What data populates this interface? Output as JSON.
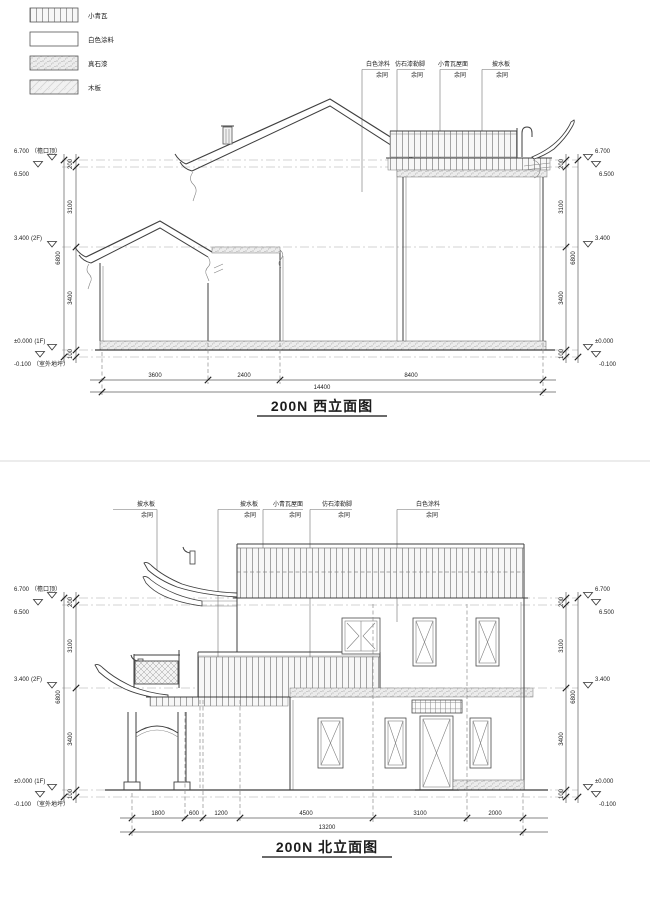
{
  "page": {
    "bg": "#ffffff",
    "divider_color": "#d8d8d8",
    "line_color": "#3f3f3f"
  },
  "legend": {
    "items": [
      {
        "id": "tile",
        "label": "小青瓦"
      },
      {
        "id": "white-paint",
        "label": "白色涂料"
      },
      {
        "id": "stone-paint",
        "label": "真石漆"
      },
      {
        "id": "wood",
        "label": "木板"
      }
    ]
  },
  "west": {
    "title": "200N 西立面图",
    "callouts": [
      {
        "label": "白色涂料",
        "sub": "余同"
      },
      {
        "label": "仿石漆勒脚",
        "sub": "余同"
      },
      {
        "label": "小青瓦屋面",
        "sub": "余同"
      },
      {
        "label": "披水板",
        "sub": "余同"
      }
    ],
    "levels_left": [
      {
        "value": "6.700",
        "note": "（檐口顶）"
      },
      {
        "value": "6.500",
        "note": ""
      },
      {
        "value": "3.400",
        "note": "(2F)"
      },
      {
        "value": "±0.000",
        "note": "(1F)"
      },
      {
        "value": "-0.100",
        "note": "（室外地坪）"
      }
    ],
    "levels_right": [
      "6.700",
      "6.500",
      "3.400",
      "±0.000",
      "-0.100"
    ],
    "vdims": [
      "200",
      "3100",
      "3400",
      "100"
    ],
    "vtotal": "6800",
    "hdims": [
      "3600",
      "2400",
      "8400"
    ],
    "htotal": "14400"
  },
  "north": {
    "title": "200N 北立面图",
    "callouts": [
      {
        "label": "披水板",
        "sub": "余同"
      },
      {
        "label": "披水板",
        "sub": "余同"
      },
      {
        "label": "小青瓦屋面",
        "sub": "余同"
      },
      {
        "label": "仿石漆勒脚",
        "sub": "余同"
      },
      {
        "label": "白色涂料",
        "sub": "余同"
      }
    ],
    "levels_left": [
      {
        "value": "6.700",
        "note": "（檐口顶）"
      },
      {
        "value": "6.500",
        "note": ""
      },
      {
        "value": "3.400",
        "note": "(2F)"
      },
      {
        "value": "±0.000",
        "note": "(1F)"
      },
      {
        "value": "-0.100",
        "note": "（室外地坪）"
      }
    ],
    "levels_right": [
      "6.700",
      "6.500",
      "3.400",
      "±0.000",
      "-0.100"
    ],
    "vdims": [
      "200",
      "3100",
      "3400",
      "100"
    ],
    "vtotal": "6800",
    "hdims": [
      "1800",
      "600",
      "1200",
      "4500",
      "3100",
      "2000"
    ],
    "htotal": "13200"
  }
}
